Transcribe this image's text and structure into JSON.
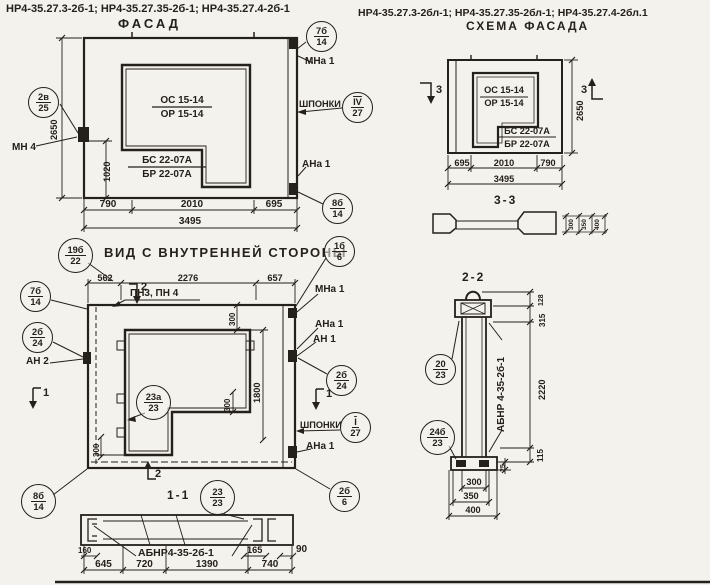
{
  "colors": {
    "ink": "#24201b",
    "paper": "#f4f2ec"
  },
  "header": {
    "left_codes": "НР4-35.27.3-2б-1; НР4-35.27.35-2б-1; НР4-35.27.4-2б-1",
    "right_codes": "НР4-35.27.3-2бл-1; НР4-35.27.35-2бл-1; НР4-35.27.4-2бл.1"
  },
  "facade": {
    "title": "ФАСАД",
    "marks": {
      "os": "ОС 15-14",
      "or": "ОР 15-14",
      "bs": "БС 22-07А",
      "br": "БР 22-07А"
    },
    "labels": {
      "mn4": "МН 4",
      "mna1": "МНа 1",
      "shponki": "ШПОНКИ",
      "ana1": "АНа 1"
    },
    "callouts": {
      "c2v25": {
        "top": "2в",
        "bot": "25"
      },
      "c7b14": {
        "top": "7б",
        "bot": "14"
      },
      "cIV27": {
        "top": "IV",
        "bot": "27"
      },
      "c8b14": {
        "top": "8б",
        "bot": "14"
      }
    },
    "dims": {
      "height": "2650",
      "inner_h": "1020",
      "w1": "790",
      "w2": "2010",
      "w3": "695",
      "total": "3495"
    }
  },
  "scheme": {
    "title": "СХЕМА ФАСАДА",
    "marks": {
      "os": "ОС 15-14",
      "or": "ОР 15-14",
      "bs": "БС 22-07А",
      "br": "БР 22-07А"
    },
    "section_marker": "3",
    "dims": {
      "w1": "695",
      "w2": "2010",
      "w3": "790",
      "total": "3495",
      "height": "2650"
    }
  },
  "section33": {
    "title": "3-3",
    "dims": {
      "d1": "300",
      "d2": "350",
      "d3": "400"
    }
  },
  "inner": {
    "title": "ВИД С ВНУТРЕННЕЙ СТОРОНЫ",
    "pn": "ПН3, ПН 4",
    "labels": {
      "an2": "АН 2",
      "mna1": "МНа 1",
      "ana1_top": "АНа 1",
      "an1": "АН 1",
      "shponki": "ШПОНКИ",
      "ana1_bot": "АНа 1"
    },
    "callouts": {
      "c19b22": {
        "top": "19б",
        "bot": "22"
      },
      "c7b14": {
        "top": "7б",
        "bot": "14"
      },
      "c2b24_left": {
        "top": "2б",
        "bot": "24"
      },
      "c1b6": {
        "top": "1б",
        "bot": "6"
      },
      "c2b24_right": {
        "top": "2б",
        "bot": "24"
      },
      "cI27": {
        "top": "I",
        "bot": "27"
      },
      "c23a23": {
        "top": "23а",
        "bot": "23"
      },
      "c8b14": {
        "top": "8б",
        "bot": "14"
      },
      "c2b6": {
        "top": "2б",
        "bot": "6"
      }
    },
    "section1": "1",
    "section2": "2",
    "dims": {
      "w1": "562",
      "w2": "2276",
      "w3": "657",
      "top300": "300",
      "corner300": "300",
      "left300": "300",
      "h1800": "1800"
    }
  },
  "section11": {
    "title": "1-1",
    "callout": {
      "top": "23",
      "bot": "23"
    },
    "label": "АБНР4-35-2б-1",
    "dims": {
      "d160": "160",
      "d165": "165",
      "d90": "90",
      "w1": "645",
      "w2": "720",
      "w3": "1390",
      "w4": "740"
    }
  },
  "section22": {
    "title": "2-2",
    "label": "АБНР 4-35-2б-1",
    "callouts": {
      "c20_23": {
        "top": "20",
        "bot": "23"
      },
      "c24b23": {
        "top": "24б",
        "bot": "23"
      }
    },
    "dims": {
      "d128": "128",
      "d315": "315",
      "d2220": "2220",
      "d115": "115",
      "d25": "25",
      "t300": "300",
      "t350": "350",
      "t400": "400"
    }
  }
}
